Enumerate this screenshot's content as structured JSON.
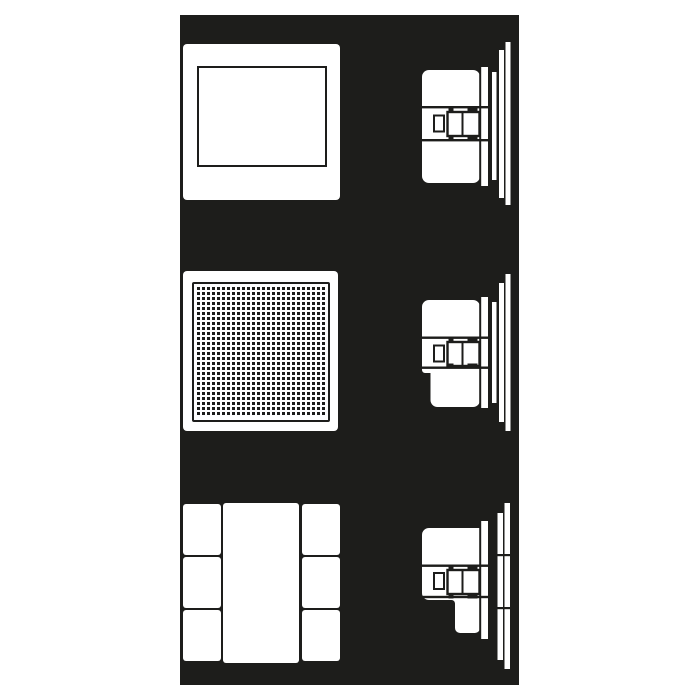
{
  "colors": {
    "ink": "#1d1d1b",
    "paper": "#ffffff",
    "page_background": "#ffffff"
  },
  "rows": [
    {
      "front_view": "blank-frame-with-rectangular-window",
      "side_view": "flush-mount-device-side-profile-with-mounting-claw-and-wall-plates"
    },
    {
      "front_view": "perforated-speaker-grille-panel",
      "side_view": "flush-mount-device-side-profile-notched-with-mounting-claw-and-wall-plates"
    },
    {
      "front_view": "three-module-switch-frame",
      "side_view": "flush-mount-device-side-profile-stepped-with-segmented-wall-plates"
    }
  ],
  "grille": {
    "dot_pitch_px": 5,
    "dot_size_px": 3,
    "approx_columns": 25,
    "approx_rows": 26
  },
  "modules": {
    "left_column_cells": 3,
    "center_cells": 1,
    "right_column_cells": 3
  }
}
